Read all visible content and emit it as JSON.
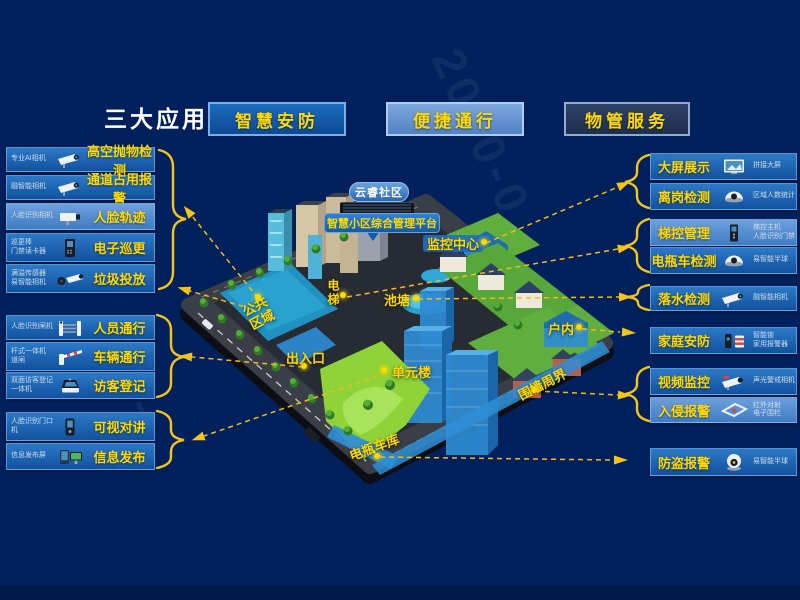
{
  "title": "三大应用",
  "apps": [
    {
      "id": "smart-security",
      "label": "智慧安防"
    },
    {
      "id": "convenient-access",
      "label": "便捷通行"
    },
    {
      "id": "property-service",
      "label": "物管服务"
    }
  ],
  "left_items": [
    {
      "id": "high-altitude-throw-detection",
      "device": "专业AI相机",
      "label": "高空抛物检测",
      "icon": "bullet-camera"
    },
    {
      "id": "channel-occupancy-alarm",
      "device": "融智能相机",
      "label": "通道占用报警",
      "icon": "bullet-camera"
    },
    {
      "id": "face-trajectory",
      "device": "人脸识别相机",
      "label": "人脸轨迹",
      "icon": "box-camera",
      "light": true
    },
    {
      "id": "electronic-patrol",
      "device": "巡更棒\n门禁读卡器",
      "label": "电子巡更",
      "icon": "card-reader"
    },
    {
      "id": "garbage-disposal",
      "device": "满溢传感器\n易智能相机",
      "label": "垃圾投放",
      "icon": "sensor-camera"
    },
    {
      "id": "personnel-access",
      "device": "人脸识别闸机",
      "label": "人员通行",
      "icon": "turnstile"
    },
    {
      "id": "vehicle-access",
      "device": "杆式一体机\n道闸",
      "label": "车辆通行",
      "icon": "barrier-gate"
    },
    {
      "id": "visitor-registration",
      "device": "双面访客登记\n一体机",
      "label": "访客登记",
      "icon": "visitor-terminal"
    },
    {
      "id": "video-intercom",
      "device": "人脸识别门口\n机",
      "label": "可视对讲",
      "icon": "door-intercom"
    },
    {
      "id": "info-publish",
      "device": "信息发布屏",
      "label": "信息发布",
      "icon": "info-screens"
    }
  ],
  "right_items": [
    {
      "id": "big-screen-display",
      "label": "大屏展示",
      "device": "拼接大屏",
      "icon": "video-wall"
    },
    {
      "id": "away-from-post-detection",
      "label": "离岗检测",
      "device": "区域人数统计",
      "icon": "dome-camera"
    },
    {
      "id": "elevator-control",
      "label": "梯控管理",
      "device": "梯控主机\n人脸识别门禁",
      "icon": "elevator-panel",
      "light": true
    },
    {
      "id": "e-bike-detection",
      "label": "电瓶车检测",
      "device": "易智能半球",
      "icon": "dome-camera"
    },
    {
      "id": "drowning-detection",
      "label": "落水检测",
      "device": "融智能相机",
      "icon": "bullet-camera"
    },
    {
      "id": "home-security",
      "label": "家庭安防",
      "device": "智能锁\n家用报警器",
      "icon": "smart-lock-alarm"
    },
    {
      "id": "video-surveillance",
      "label": "视频监控",
      "device": "声光警戒相机",
      "icon": "alert-bullet-camera"
    },
    {
      "id": "intrusion-alarm",
      "label": "入侵报警",
      "device": "红外对射\n电子围栏",
      "icon": "fence",
      "light": true
    },
    {
      "id": "anti-theft-alarm",
      "label": "防盗报警",
      "device": "易智能半球",
      "icon": "turret-camera"
    }
  ],
  "map": {
    "community_name": "云睿社区",
    "platform_name": "智慧小区综合管理平台",
    "areas": [
      {
        "id": "monitoring-center",
        "name": "监控中心"
      },
      {
        "id": "elevator",
        "name": "电梯"
      },
      {
        "id": "pond",
        "name": "池塘"
      },
      {
        "id": "public-area",
        "name": "公共\n区域"
      },
      {
        "id": "entrance-exit",
        "name": "出入口"
      },
      {
        "id": "unit-building",
        "name": "单元楼"
      },
      {
        "id": "indoor",
        "name": "户内"
      },
      {
        "id": "perimeter-wall",
        "name": "围墙周界"
      },
      {
        "id": "ebike-garage",
        "name": "电瓶车库"
      }
    ]
  },
  "watermarks": [
    "2020-0",
    "33-"
  ],
  "colors": {
    "background": "#02215c",
    "accent_yellow": "#ffd900",
    "line_yellow": "#f6c419",
    "bar_blue": "#11529e",
    "highlight_blue": "#2e8ed6"
  }
}
